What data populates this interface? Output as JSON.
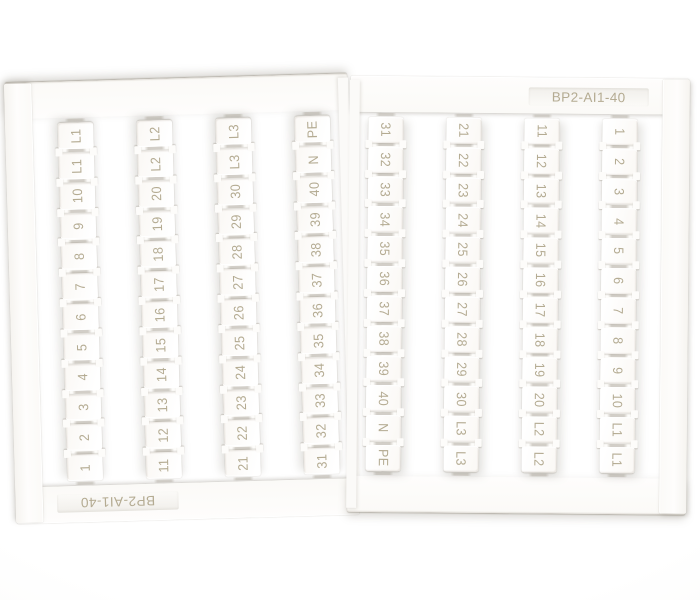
{
  "product": {
    "model": "BP2-AI1-40"
  },
  "colors": {
    "print_text": "#b4ab92",
    "plastic": "#fdfcfa",
    "background": "#ffffff"
  },
  "card": {
    "halves": [
      {
        "id": "left",
        "orientation": "rotated-180",
        "label_position": "bottom-left"
      },
      {
        "id": "right",
        "orientation": "upright",
        "label_position": "top-right"
      }
    ],
    "strips": [
      {
        "markers": [
          "31",
          "32",
          "33",
          "34",
          "35",
          "36",
          "37",
          "38",
          "39",
          "40",
          "N",
          "PE"
        ]
      },
      {
        "markers": [
          "21",
          "22",
          "23",
          "24",
          "25",
          "26",
          "27",
          "28",
          "29",
          "30",
          "L3",
          "L3"
        ]
      },
      {
        "markers": [
          "11",
          "12",
          "13",
          "14",
          "15",
          "16",
          "17",
          "18",
          "19",
          "20",
          "L2",
          "L2"
        ]
      },
      {
        "markers": [
          "1",
          "2",
          "3",
          "4",
          "5",
          "6",
          "7",
          "8",
          "9",
          "10",
          "L1",
          "L1"
        ]
      }
    ]
  }
}
